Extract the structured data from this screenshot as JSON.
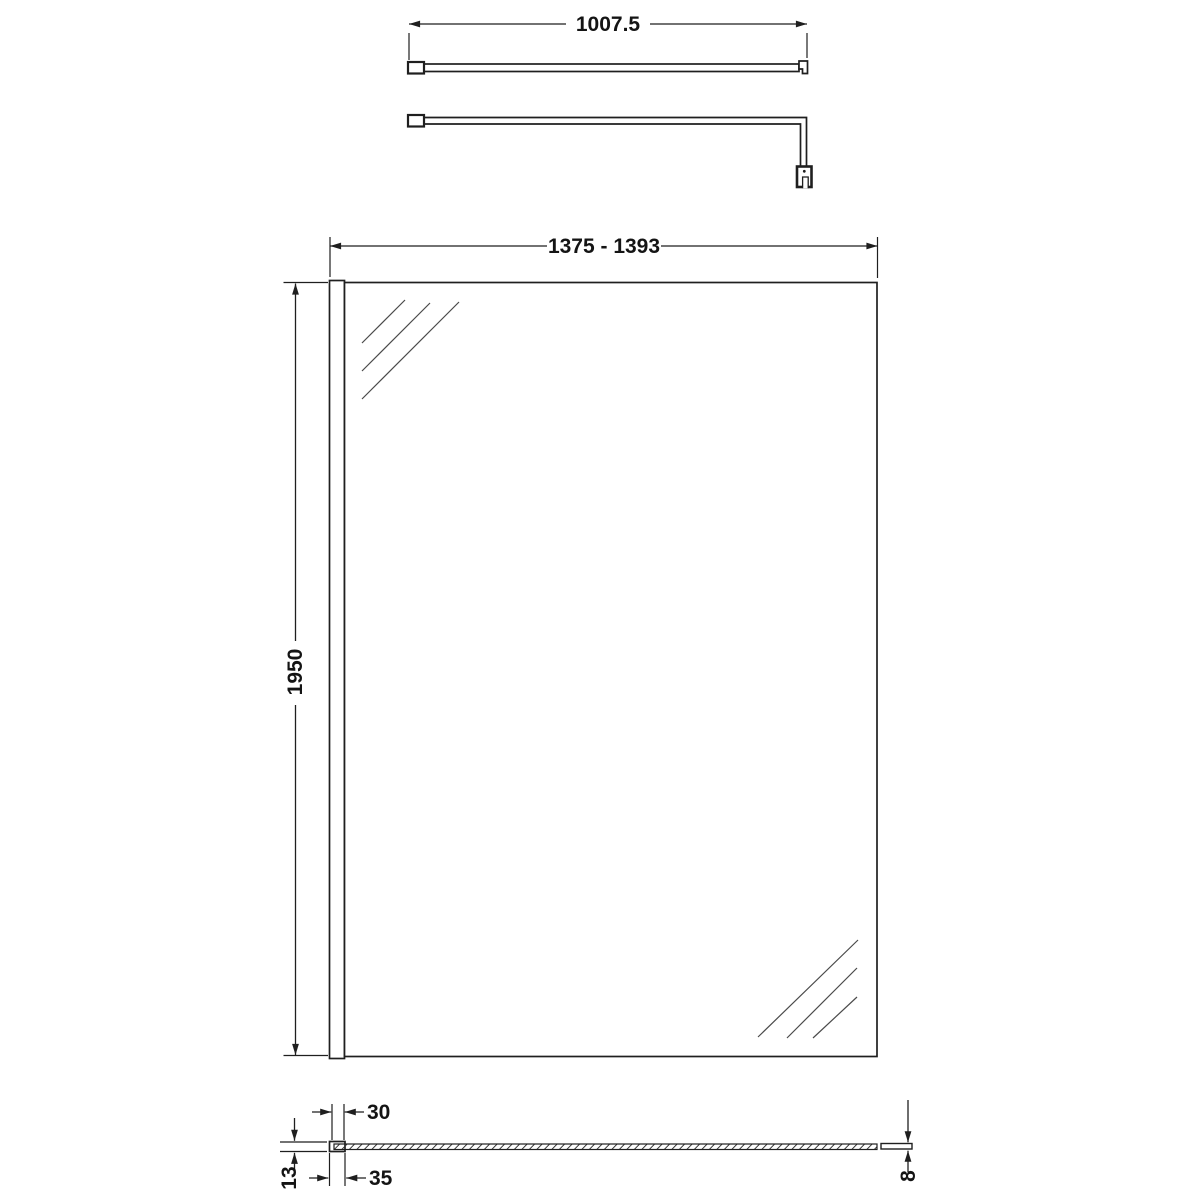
{
  "drawing": {
    "kind": "technical-dimension-drawing",
    "background_color": "#ffffff",
    "line_color": "#1f1f1f",
    "labels": {
      "support_bar_length": "1007.5",
      "panel_width_range": "1375 - 1393",
      "panel_height": "1950",
      "profile_slot_width": "30",
      "profile_depth": "13",
      "profile_outer_width": "35",
      "glass_thickness": "8"
    }
  }
}
